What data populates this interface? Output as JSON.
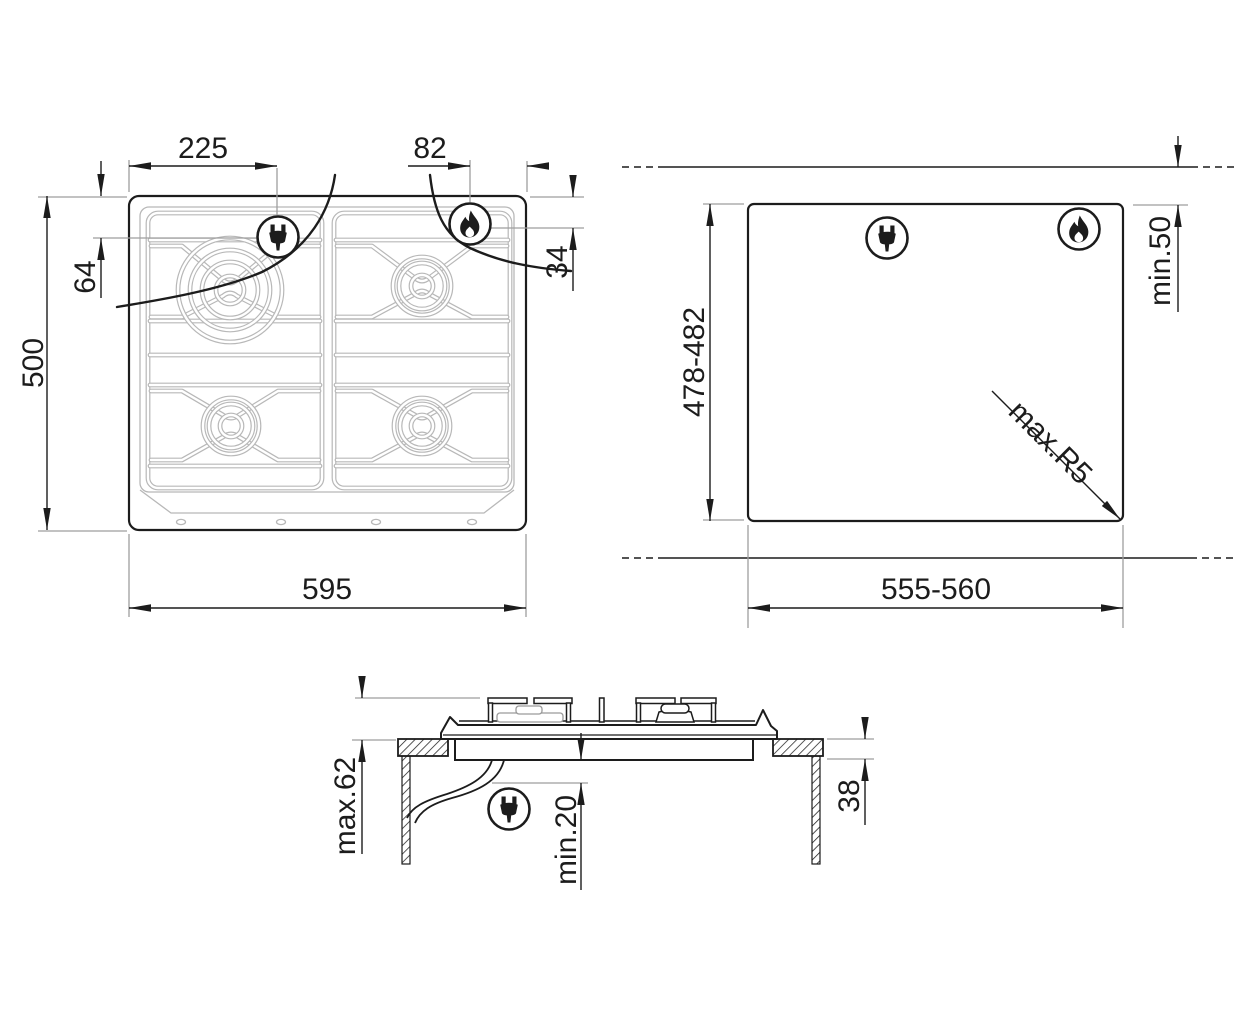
{
  "hob_top_view": {
    "elec_offset_x": "225",
    "gas_offset_x": "82",
    "elec_offset_y": "64",
    "gas_offset_y": "34",
    "overall_depth": "500",
    "overall_width": "595"
  },
  "cutout_view": {
    "cutout_depth": "478-482",
    "min_wall_clearance": "min.50",
    "max_corner_radius": "max.R5",
    "cutout_width": "555-560"
  },
  "section_view": {
    "max_height_protrusion": "max.62",
    "min_clearance_below": "min.20",
    "recess_depth": "38"
  },
  "icons": {
    "electric_connection": "power-plug-icon",
    "gas_connection": "gas-flame-icon"
  },
  "colors": {
    "line": "#1c1c1c",
    "extension_line": "#9e9e9e",
    "grate_line": "#b8b8b8"
  }
}
